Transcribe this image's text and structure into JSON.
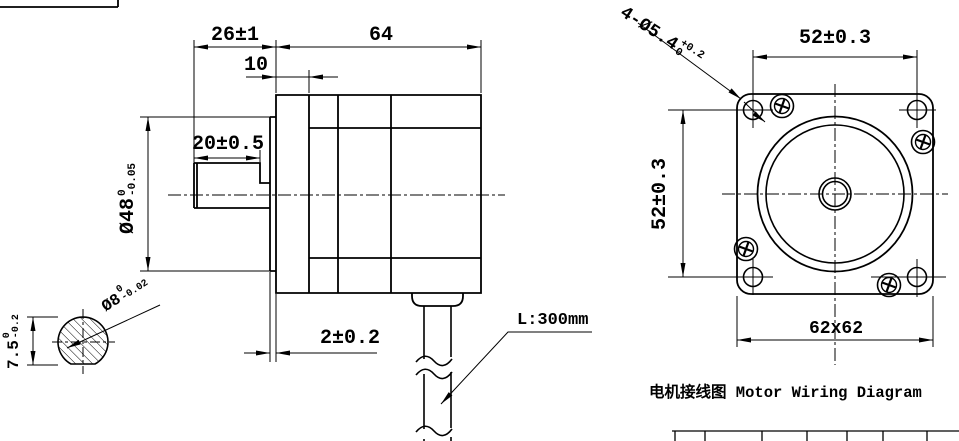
{
  "colors": {
    "line": "#000000",
    "background": "#ffffff"
  },
  "side_view": {
    "dim_shaft_to_flange": "26±1",
    "dim_body_length": "64",
    "dim_front_cap": "10",
    "dim_shaft_length": "20±0.5",
    "dim_boss_height": "2±0.2",
    "dim_boss_diameter": {
      "main": "Ø48",
      "upper": "0",
      "lower": "-0.05"
    },
    "cable_length_label": "L:300mm"
  },
  "shaft_section": {
    "dim_flat_height": {
      "main": "7.5",
      "upper": "0",
      "lower": "-0.2"
    },
    "dim_shaft_diameter": {
      "main": "Ø8",
      "upper": "0",
      "lower": "-0.02"
    }
  },
  "front_view": {
    "dim_hole_spacing_horizontal": "52±0.3",
    "dim_hole_spacing_vertical": "52±0.3",
    "dim_face_size": "62x62",
    "dim_mounting_holes": {
      "main": "4-Ø5.4",
      "upper": "+0.2",
      "lower": "0"
    }
  },
  "wiring": {
    "title": "电机接线图 Motor Wiring Diagram"
  }
}
